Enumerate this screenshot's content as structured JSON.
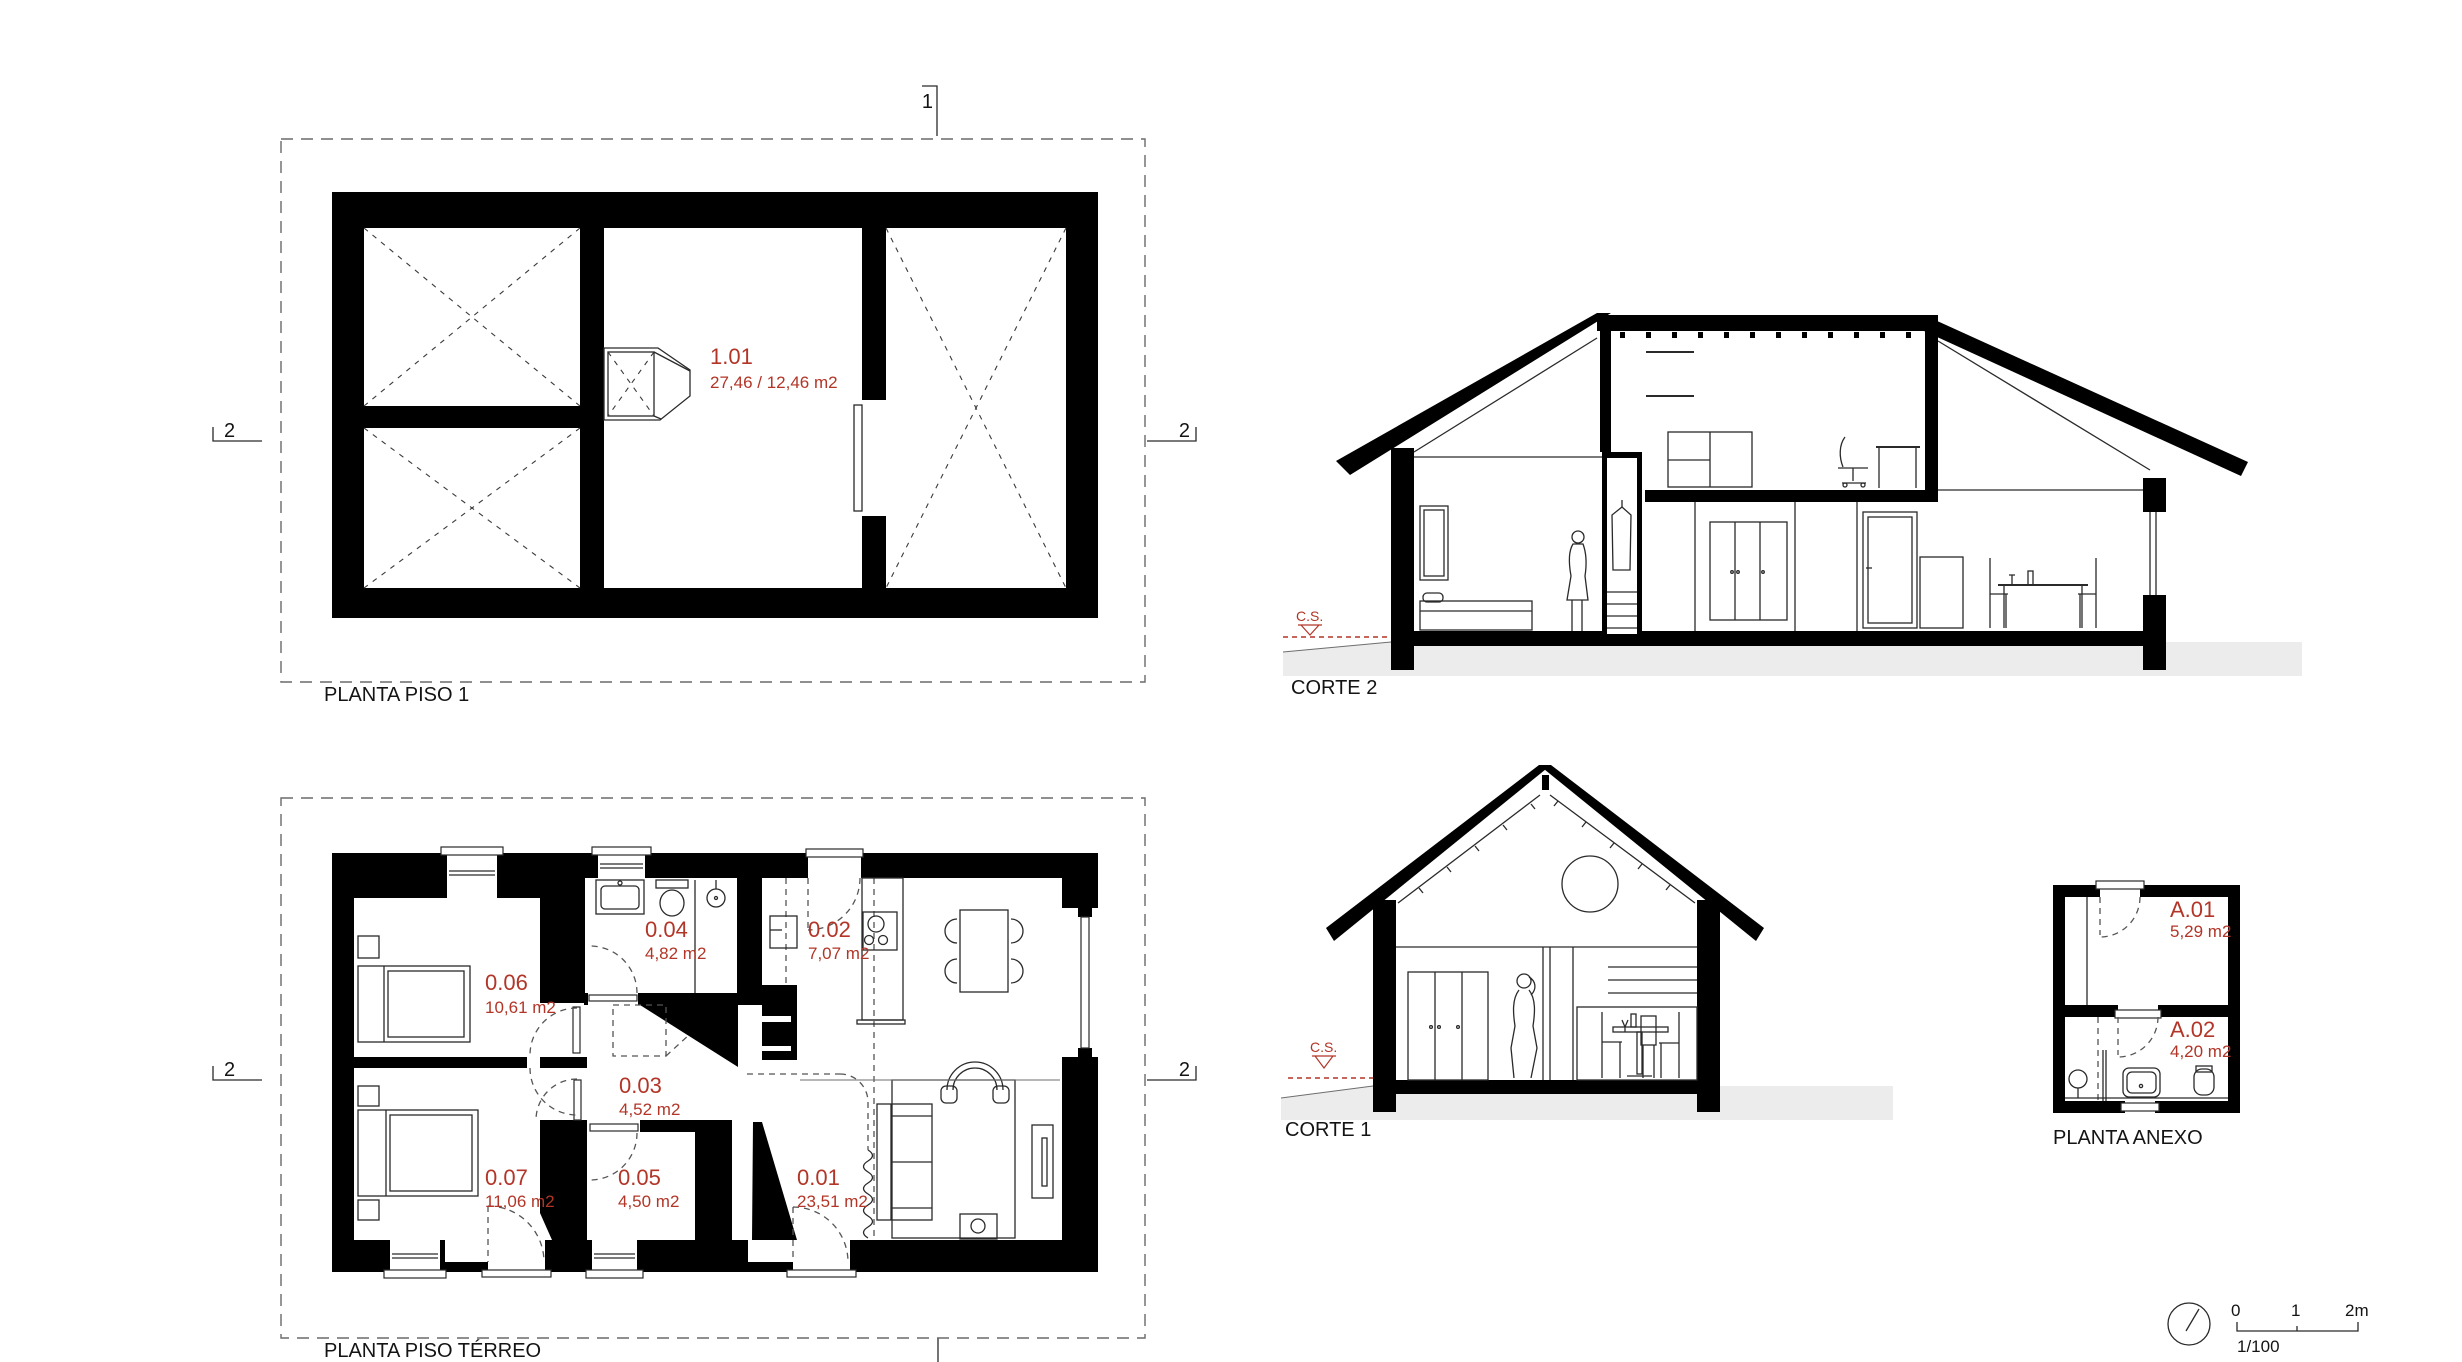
{
  "palette": {
    "accent_red": "#b23527",
    "wall_black": "#000000",
    "ground_gray": "#ececec"
  },
  "icons": {
    "north_indicator": "circle-with-needle"
  },
  "plans": {
    "piso1": {
      "title": "PLANTA PISO 1",
      "room": {
        "id": "1.01",
        "area": "27,46 / 12,46 m2"
      }
    },
    "terreo": {
      "title": "PLANTA PISO TÉRREO",
      "rooms": [
        {
          "id": "0.06",
          "area": "10,61 m2"
        },
        {
          "id": "0.04",
          "area": "4,82 m2"
        },
        {
          "id": "0.02",
          "area": "7,07 m2"
        },
        {
          "id": "0.03",
          "area": "4,52 m2"
        },
        {
          "id": "0.07",
          "area": "11,06 m2"
        },
        {
          "id": "0.05",
          "area": "4,50 m2"
        },
        {
          "id": "0.01",
          "area": "23,51 m2"
        }
      ]
    },
    "anexo": {
      "title": "PLANTA ANEXO",
      "rooms": [
        {
          "id": "A.01",
          "area": "5,29 m2"
        },
        {
          "id": "A.02",
          "area": "4,20 m2"
        }
      ]
    }
  },
  "sections": {
    "corte2": {
      "title": "CORTE 2",
      "level_marker": "C.S."
    },
    "corte1": {
      "title": "CORTE 1",
      "level_marker": "C.S."
    }
  },
  "section_markers": {
    "cut1": "1",
    "cut2": "2"
  },
  "scalebar": {
    "zero": "0",
    "one": "1",
    "two": "2m",
    "ratio": "1/100"
  }
}
